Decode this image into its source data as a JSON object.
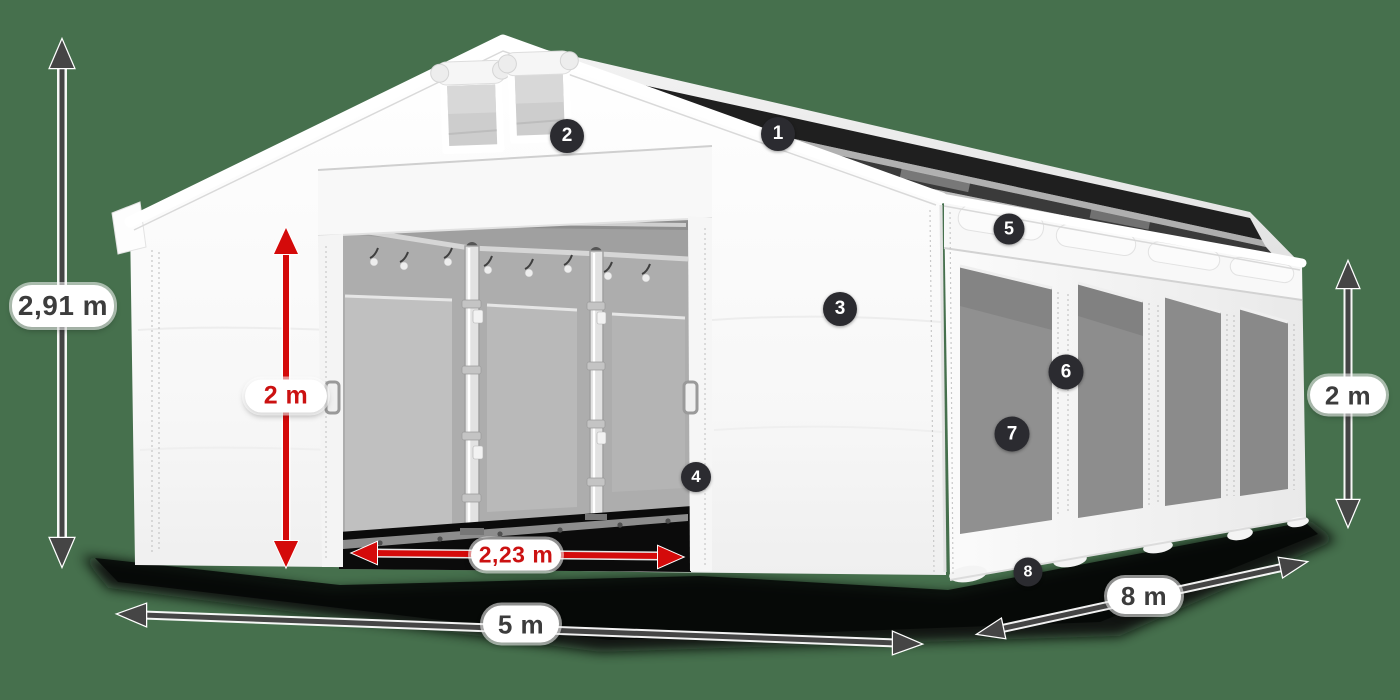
{
  "diagram": {
    "type": "product-dimension-diagram",
    "background_color": "#46704d",
    "dimensions": {
      "total_height": "2,91 m",
      "door_height": "2 m",
      "door_width": "2,23 m",
      "front_width": "5 m",
      "side_length": "8 m",
      "wall_height": "2 m"
    },
    "callouts": [
      {
        "number": "1"
      },
      {
        "number": "2"
      },
      {
        "number": "3"
      },
      {
        "number": "4"
      },
      {
        "number": "5"
      },
      {
        "number": "6"
      },
      {
        "number": "7"
      },
      {
        "number": "8"
      }
    ],
    "colors": {
      "arrow_dark": "#454545",
      "arrow_red": "#d40a0a",
      "badge_background": "#2b2b30",
      "badge_text": "#ffffff",
      "label_background": "#ffffff",
      "label_text_dark": "#3c3c3c",
      "label_text_red": "#cb1111"
    }
  }
}
